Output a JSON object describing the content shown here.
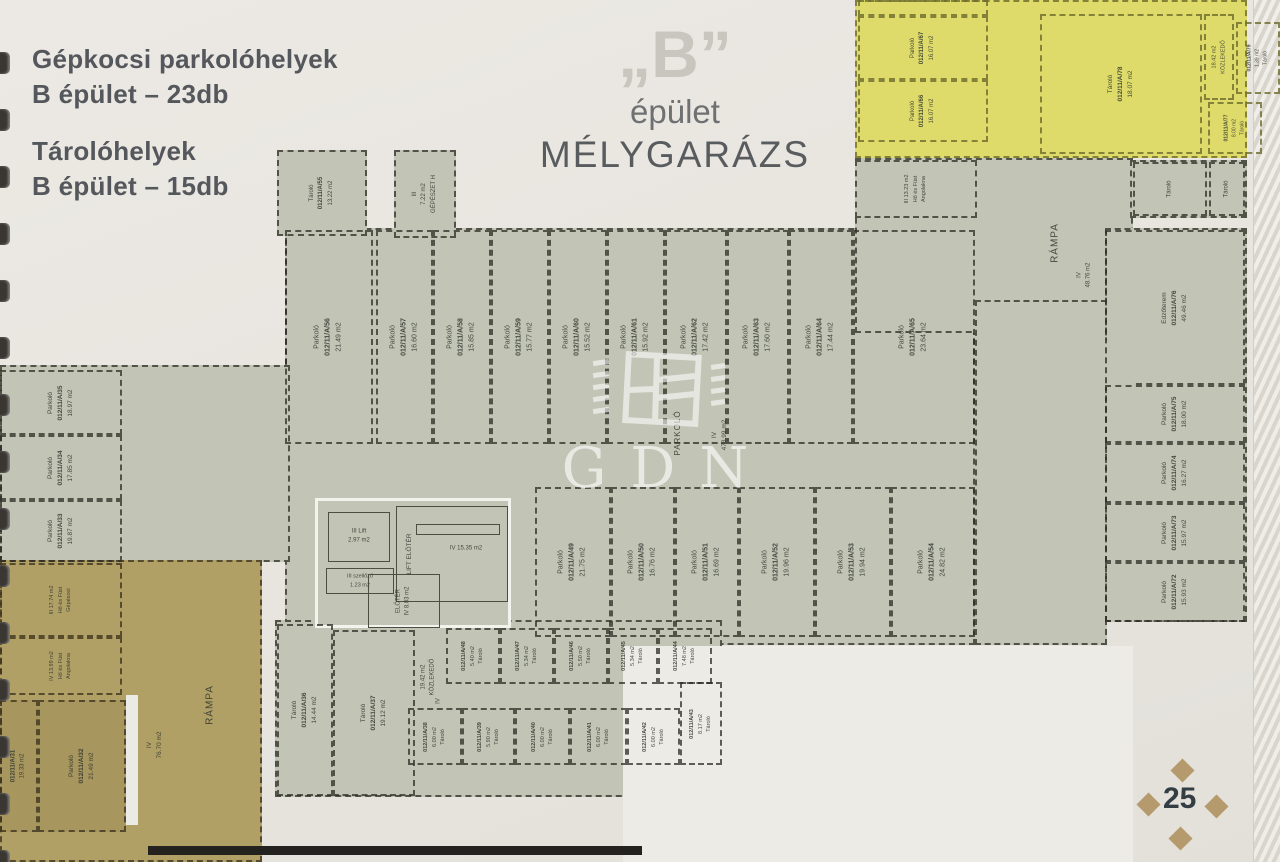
{
  "page": {
    "legend": {
      "line1": "Gépkocsi parkolóhelyek",
      "line2": "B épület – 23db",
      "line3": "Tárolóhelyek",
      "line4": "B épület – 15db"
    },
    "title": {
      "quote": "„B”",
      "sub": "épület",
      "main": "MÉLYGARÁZS"
    },
    "watermark": "GDN",
    "page_number": "25"
  },
  "colors": {
    "floor": "#c2c4b5",
    "gold": "#b1a066",
    "yellow": "#dfdb6b",
    "paper2": "#edebe5",
    "goldstall": "rgba(40,30,5,0.07)"
  },
  "plan": {
    "zones": [
      {
        "n": "zone-main-hall",
        "x": 285,
        "y": 228,
        "w": 690,
        "h": 417,
        "f": "floor",
        "b": 1
      },
      {
        "n": "zone-west-wing",
        "x": 0,
        "y": 365,
        "w": 290,
        "h": 197,
        "f": "floor",
        "b": 1
      },
      {
        "n": "zone-north-east",
        "x": 855,
        "y": 158,
        "w": 278,
        "h": 175,
        "f": "floor",
        "b": 1
      },
      {
        "n": "zone-east-corridor",
        "x": 975,
        "y": 300,
        "w": 132,
        "h": 345,
        "f": "floor",
        "b": 1
      },
      {
        "n": "zone-east-wing",
        "x": 1105,
        "y": 228,
        "w": 142,
        "h": 394,
        "f": "floor",
        "b": 1
      },
      {
        "n": "zone-ne-storerooms",
        "x": 1130,
        "y": 160,
        "w": 117,
        "h": 58,
        "f": "floor",
        "b": 1
      },
      {
        "n": "zone-south-storage",
        "x": 275,
        "y": 620,
        "w": 447,
        "h": 177,
        "f": "floor",
        "b": 1
      },
      {
        "n": "zone-ramp-gold",
        "x": 0,
        "y": 560,
        "w": 262,
        "h": 302,
        "f": "gold",
        "b": 4
      },
      {
        "n": "zone-yellow-garage",
        "x": 855,
        "y": 0,
        "w": 392,
        "h": 158,
        "f": "yellow",
        "b": 3
      },
      {
        "n": "zone-white-cutout",
        "x": 623,
        "y": 646,
        "w": 510,
        "h": 216,
        "f": "paper2",
        "b": 0
      },
      {
        "n": "zone-lift-core",
        "x": 315,
        "y": 498,
        "w": 196,
        "h": 130,
        "f": "floor",
        "b": 5
      }
    ],
    "rooms": [
      {
        "n": "room-tarolo-a55",
        "x": 277,
        "y": 150,
        "w": 90,
        "h": 86,
        "f": "floor",
        "b": 1,
        "t": [
          "Tároló",
          "012/11/A/55",
          "13.22 m2"
        ],
        "r": 1,
        "fs": 6
      },
      {
        "n": "room-gepeszet-h",
        "x": 394,
        "y": 150,
        "w": 62,
        "h": 88,
        "f": "floor",
        "b": 1,
        "t": [
          "III",
          "7.22 m2",
          "GÉPÉSZET H"
        ],
        "r": 1,
        "fs": 6
      },
      {
        "n": "room-parkolo-a56",
        "x": 285,
        "y": 230,
        "w": 88,
        "h": 214,
        "b": 1,
        "t": [
          "Parkoló",
          "012/11/A/56",
          "21.49 m2"
        ],
        "r": 1,
        "fs": 7
      },
      {
        "n": "room-parkolo-a57",
        "x": 376,
        "y": 230,
        "w": 57,
        "h": 214,
        "b": 1,
        "t": [
          "Parkoló",
          "012/11/A/57",
          "16.60 m2"
        ],
        "r": 1,
        "fs": 7
      },
      {
        "n": "room-parkolo-a58",
        "x": 433,
        "y": 230,
        "w": 58,
        "h": 214,
        "b": 1,
        "t": [
          "Parkoló",
          "012/11/A/58",
          "15.85 m2"
        ],
        "r": 1,
        "fs": 7
      },
      {
        "n": "room-parkolo-a59",
        "x": 491,
        "y": 230,
        "w": 58,
        "h": 214,
        "b": 1,
        "t": [
          "Parkoló",
          "012/11/A/59",
          "15.77 m2"
        ],
        "r": 1,
        "fs": 7
      },
      {
        "n": "room-parkolo-a60",
        "x": 549,
        "y": 230,
        "w": 58,
        "h": 214,
        "b": 1,
        "t": [
          "Parkoló",
          "012/11/A/60",
          "15.52 m2"
        ],
        "r": 1,
        "fs": 7
      },
      {
        "n": "room-parkolo-a61",
        "x": 607,
        "y": 230,
        "w": 58,
        "h": 214,
        "b": 1,
        "t": [
          "Parkoló",
          "012/11/A/61",
          "15.92 m2"
        ],
        "r": 1,
        "fs": 7
      },
      {
        "n": "room-parkolo-a62",
        "x": 665,
        "y": 230,
        "w": 62,
        "h": 214,
        "b": 1,
        "t": [
          "Parkoló",
          "012/11/A/62",
          "17.42 m2"
        ],
        "r": 1,
        "fs": 7
      },
      {
        "n": "room-parkolo-a63",
        "x": 727,
        "y": 230,
        "w": 62,
        "h": 214,
        "b": 1,
        "t": [
          "Parkoló",
          "012/11/A/63",
          "17.60 m2"
        ],
        "r": 1,
        "fs": 7
      },
      {
        "n": "room-parkolo-a64",
        "x": 789,
        "y": 230,
        "w": 64,
        "h": 214,
        "b": 1,
        "t": [
          "Parkoló",
          "012/11/A/64",
          "17.44 m2"
        ],
        "r": 1,
        "fs": 7
      },
      {
        "n": "room-parkolo-a65",
        "x": 853,
        "y": 230,
        "w": 122,
        "h": 214,
        "b": 1,
        "t": [
          "Parkoló",
          "012/11/A/65",
          "23.64 m2"
        ],
        "r": 1,
        "fs": 7
      },
      {
        "n": "room-parkolo-a49",
        "x": 535,
        "y": 487,
        "w": 76,
        "h": 150,
        "b": 1,
        "t": [
          "Parkoló",
          "012/11/A/49",
          "21.75 m2"
        ],
        "r": 1,
        "fs": 7
      },
      {
        "n": "room-parkolo-a50",
        "x": 611,
        "y": 487,
        "w": 64,
        "h": 150,
        "b": 1,
        "t": [
          "Parkoló",
          "012/11/A/50",
          "16.76 m2"
        ],
        "r": 1,
        "fs": 7
      },
      {
        "n": "room-parkolo-a51",
        "x": 675,
        "y": 487,
        "w": 64,
        "h": 150,
        "b": 1,
        "t": [
          "Parkoló",
          "012/11/A/51",
          "16.69 m2"
        ],
        "r": 1,
        "fs": 7
      },
      {
        "n": "room-parkolo-a52",
        "x": 739,
        "y": 487,
        "w": 76,
        "h": 150,
        "b": 1,
        "t": [
          "Parkoló",
          "012/11/A/52",
          "19.96 m2"
        ],
        "r": 1,
        "fs": 7
      },
      {
        "n": "room-parkolo-a53",
        "x": 815,
        "y": 487,
        "w": 76,
        "h": 150,
        "b": 1,
        "t": [
          "Parkoló",
          "012/11/A/53",
          "19.94 m2"
        ],
        "r": 1,
        "fs": 7
      },
      {
        "n": "room-parkolo-a54",
        "x": 891,
        "y": 487,
        "w": 84,
        "h": 150,
        "b": 1,
        "t": [
          "Parkoló",
          "012/11/A/54",
          "24.82 m2"
        ],
        "r": 1,
        "fs": 7
      },
      {
        "n": "room-parkolo-a35",
        "x": 0,
        "y": 370,
        "w": 122,
        "h": 65,
        "b": 1,
        "t": [
          "Parkoló",
          "012/11/A/35",
          "18.97 m2"
        ],
        "r": 1,
        "fs": 6.5
      },
      {
        "n": "room-parkolo-a34",
        "x": 0,
        "y": 435,
        "w": 122,
        "h": 65,
        "b": 1,
        "t": [
          "Parkoló",
          "012/11/A/34",
          "17.85 m2"
        ],
        "r": 1,
        "fs": 6.5
      },
      {
        "n": "room-parkolo-a33",
        "x": 0,
        "y": 500,
        "w": 122,
        "h": 62,
        "b": 1,
        "t": [
          "Parkoló",
          "012/11/A/33",
          "19.87 m2"
        ],
        "r": 1,
        "fs": 6.5
      },
      {
        "n": "room-edzoterem-a76",
        "x": 1105,
        "y": 230,
        "w": 140,
        "h": 155,
        "b": 1,
        "cls": "cut-bl",
        "t": [
          "Edzőterem",
          "012/11/A/76",
          "49.46 m2"
        ],
        "r": 1,
        "fs": 6.5
      },
      {
        "n": "room-parkolo-a75",
        "x": 1105,
        "y": 385,
        "w": 140,
        "h": 58,
        "b": 1,
        "t": [
          "Parkoló",
          "012/11/A/75",
          "18.00 m2"
        ],
        "r": 1,
        "fs": 6.5
      },
      {
        "n": "room-parkolo-a74",
        "x": 1105,
        "y": 443,
        "w": 140,
        "h": 60,
        "b": 1,
        "t": [
          "Parkoló",
          "012/11/A/74",
          "16.27 m2"
        ],
        "r": 1,
        "fs": 6.5
      },
      {
        "n": "room-parkolo-a73",
        "x": 1105,
        "y": 503,
        "w": 140,
        "h": 59,
        "b": 1,
        "t": [
          "Parkoló",
          "012/11/A/73",
          "15.97 m2"
        ],
        "r": 1,
        "fs": 6.5
      },
      {
        "n": "room-parkolo-a72",
        "x": 1105,
        "y": 562,
        "w": 140,
        "h": 60,
        "b": 1,
        "t": [
          "Parkoló",
          "012/11/A/72",
          "15.93 m2"
        ],
        "r": 1,
        "fs": 6.5
      },
      {
        "n": "room-parkolo-y-cut",
        "x": 858,
        "y": 0,
        "w": 130,
        "h": 16,
        "b": 3
      },
      {
        "n": "room-parkolo-a67",
        "x": 858,
        "y": 16,
        "w": 130,
        "h": 64,
        "b": 3,
        "t": [
          "Parkoló",
          "012/11/A/67",
          "16.07 m2"
        ],
        "r": 1,
        "fs": 6
      },
      {
        "n": "room-parkolo-a66",
        "x": 858,
        "y": 80,
        "w": 130,
        "h": 62,
        "b": 3,
        "t": [
          "Parkoló",
          "012/11/A/66",
          "16.07 m2"
        ],
        "r": 1,
        "fs": 6
      },
      {
        "n": "room-tarolo-a78",
        "x": 1040,
        "y": 14,
        "w": 162,
        "h": 140,
        "b": 3,
        "t": [
          "Tároló",
          "012/11/A/78",
          "18.07 m2"
        ],
        "r": 1,
        "fs": 6.5
      },
      {
        "n": "room-kozlekedo-ne",
        "x": 1204,
        "y": 14,
        "w": 30,
        "h": 86,
        "b": 3,
        "t": [
          "18.42 m2",
          "KÖZLEKEDŐ"
        ],
        "r": 1,
        "fs": 5.5
      },
      {
        "n": "room-tarolo-a79",
        "x": 1236,
        "y": 22,
        "w": 44,
        "h": 72,
        "b": 3,
        "t": [
          "012/11/A/79",
          "1.39 m2",
          "Tároló"
        ],
        "r": 1,
        "fs": 5
      },
      {
        "n": "room-tarolo-a77",
        "x": 1208,
        "y": 102,
        "w": 54,
        "h": 52,
        "b": 3,
        "t": [
          "012/11/A/77",
          "8.00 m2",
          "Tároló"
        ],
        "r": 1,
        "fs": 5
      },
      {
        "n": "room-ho-fust-angolakna-ne",
        "x": 855,
        "y": 160,
        "w": 122,
        "h": 58,
        "f": "floor",
        "b": 1,
        "t": [
          "III  13.23 m2",
          "Hő és Füst",
          "Angolakna"
        ],
        "r": 1,
        "fs": 5.5
      },
      {
        "n": "room-tarolo-ne-1",
        "x": 1133,
        "y": 162,
        "w": 74,
        "h": 54,
        "b": 1,
        "t": [
          "Tároló"
        ],
        "r": 1,
        "fs": 6
      },
      {
        "n": "room-tarolo-ne-2",
        "x": 1209,
        "y": 162,
        "w": 36,
        "h": 54,
        "b": 1,
        "t": [
          "Tároló"
        ],
        "r": 1,
        "fs": 6
      },
      {
        "n": "label-rampa-ne",
        "x": 1020,
        "y": 168,
        "w": 70,
        "h": 150,
        "b": 0,
        "t": [
          "RÁMPA"
        ],
        "r": 1,
        "fs": 10,
        "ls": 1
      },
      {
        "n": "label-rampa-ne-area",
        "x": 1055,
        "y": 230,
        "w": 60,
        "h": 90,
        "b": 0,
        "t": [
          "IV",
          "48.76 m2"
        ],
        "r": 1,
        "fs": 6
      },
      {
        "n": "label-parkolo-main",
        "x": 655,
        "y": 375,
        "w": 45,
        "h": 115,
        "b": 0,
        "t": [
          "PARKOLÓ"
        ],
        "r": 1,
        "fs": 8,
        "ls": 1
      },
      {
        "n": "label-parkolo-main-area",
        "x": 697,
        "y": 385,
        "w": 45,
        "h": 100,
        "b": 0,
        "t": [
          "IV",
          "473.99 m2"
        ],
        "r": 1,
        "fs": 6.5
      },
      {
        "n": "room-lift",
        "x": 328,
        "y": 512,
        "w": 62,
        "h": 50,
        "b": 2,
        "t": [
          "III      Lift",
          "2.97 m2"
        ],
        "r": 0,
        "fs": 6
      },
      {
        "n": "room-szellozo",
        "x": 326,
        "y": 568,
        "w": 68,
        "h": 26,
        "b": 2,
        "t": [
          "III  szellőző",
          "1.23 m2"
        ],
        "r": 0,
        "fs": 5.5
      },
      {
        "n": "room-lift-eloter",
        "x": 396,
        "y": 506,
        "w": 112,
        "h": 96,
        "b": 2
      },
      {
        "n": "room-stair-bar",
        "x": 416,
        "y": 524,
        "w": 84,
        "h": 11,
        "b": 2
      },
      {
        "n": "label-lift-eloter",
        "x": 398,
        "y": 510,
        "w": 24,
        "h": 88,
        "b": 0,
        "t": [
          "LIFT ELŐTÉR"
        ],
        "r": 1,
        "fs": 6.5
      },
      {
        "n": "label-lift-eloter-area",
        "x": 428,
        "y": 534,
        "w": 76,
        "h": 30,
        "b": 0,
        "t": [
          "IV      15.35 m2"
        ],
        "r": 0,
        "fs": 6
      },
      {
        "n": "room-eloter",
        "x": 368,
        "y": 574,
        "w": 72,
        "h": 54,
        "b": 2,
        "t": [
          "ELŐTÉR",
          "IV  8.03 m2"
        ],
        "r": 1,
        "fs": 6
      },
      {
        "n": "room-ho-fust-gepeszet",
        "x": 0,
        "y": 563,
        "w": 122,
        "h": 74,
        "b": 4,
        "t": [
          "III  17.74 m2",
          "Hő és Füst",
          "Gépészet"
        ],
        "r": 1,
        "fs": 5.5
      },
      {
        "n": "room-ho-fust-angolakna-sw",
        "x": 0,
        "y": 637,
        "w": 122,
        "h": 58,
        "b": 4,
        "t": [
          "IV  13.99 m2",
          "Hő és Füst",
          "Angolakna"
        ],
        "r": 1,
        "fs": 5.5
      },
      {
        "n": "room-parkolo-a31",
        "x": 0,
        "y": 700,
        "w": 38,
        "h": 132,
        "f": "goldstall",
        "b": 4,
        "t": [
          "012/11/A/31",
          "19.33 m2"
        ],
        "r": 1,
        "fs": 6
      },
      {
        "n": "room-parkolo-a32",
        "x": 38,
        "y": 700,
        "w": 88,
        "h": 132,
        "f": "goldstall",
        "b": 4,
        "t": [
          "Parkoló",
          "012/11/A/32",
          "21.49 m2"
        ],
        "r": 1,
        "fs": 6.5
      },
      {
        "n": "wall-gap-gold",
        "x": 126,
        "y": 695,
        "w": 12,
        "h": 130,
        "f": "#eceae4",
        "b": 0
      },
      {
        "n": "label-rampa-sw",
        "x": 180,
        "y": 635,
        "w": 60,
        "h": 140,
        "b": 0,
        "t": [
          "RÁMPA"
        ],
        "r": 1,
        "fs": 10,
        "ls": 1
      },
      {
        "n": "label-rampa-sw-area",
        "x": 125,
        "y": 690,
        "w": 60,
        "h": 110,
        "b": 0,
        "t": [
          "IV",
          "76.70 m2"
        ],
        "r": 1,
        "fs": 6.5
      },
      {
        "n": "room-tarolo-a36",
        "x": 277,
        "y": 624,
        "w": 56,
        "h": 172,
        "b": 1,
        "t": [
          "Tároló",
          "012/11/A/36",
          "14.44 m2"
        ],
        "r": 1,
        "fs": 6.5
      },
      {
        "n": "room-tarolo-a37",
        "x": 333,
        "y": 630,
        "w": 82,
        "h": 166,
        "b": 1,
        "t": [
          "Tároló",
          "012/11/A/37",
          "19.12 m2"
        ],
        "r": 1,
        "fs": 6.5
      },
      {
        "n": "label-kozlekedo-south",
        "x": 412,
        "y": 632,
        "w": 34,
        "h": 90,
        "b": 0,
        "t": [
          "19.42 m2",
          "KÖZLEKEDŐ"
        ],
        "r": 1,
        "fs": 6
      },
      {
        "n": "label-kozlekedo-south-iv",
        "x": 428,
        "y": 688,
        "w": 22,
        "h": 26,
        "b": 0,
        "t": [
          "IV"
        ],
        "r": 1,
        "fs": 6
      },
      {
        "n": "room-tarolo-a48",
        "x": 446,
        "y": 628,
        "w": 54,
        "h": 56,
        "b": 1,
        "t": [
          "012/11/A/48",
          "5.40 m2",
          "Tároló"
        ],
        "r": 1,
        "fs": 5.5
      },
      {
        "n": "room-tarolo-a47",
        "x": 500,
        "y": 628,
        "w": 54,
        "h": 56,
        "b": 1,
        "t": [
          "012/11/A/47",
          "5.34 m2",
          "Tároló"
        ],
        "r": 1,
        "fs": 5.5
      },
      {
        "n": "room-tarolo-a46",
        "x": 554,
        "y": 628,
        "w": 54,
        "h": 56,
        "b": 1,
        "t": [
          "012/11/A/46",
          "5.50 m2",
          "Tároló"
        ],
        "r": 1,
        "fs": 5.5
      },
      {
        "n": "room-tarolo-a45",
        "x": 608,
        "y": 628,
        "w": 50,
        "h": 56,
        "b": 1,
        "t": [
          "012/11/A/45",
          "5.34 m2",
          "Tároló"
        ],
        "r": 1,
        "fs": 5.5
      },
      {
        "n": "room-tarolo-a44",
        "x": 658,
        "y": 628,
        "w": 54,
        "h": 56,
        "b": 1,
        "t": [
          "012/11/A/44",
          "7.48 m2",
          "Tároló"
        ],
        "r": 1,
        "fs": 5.5
      },
      {
        "n": "room-tarolo-a38",
        "x": 408,
        "y": 708,
        "w": 54,
        "h": 57,
        "b": 1,
        "t": [
          "012/11/A/38",
          "6.00 m2",
          "Tároló"
        ],
        "r": 1,
        "fs": 5.5
      },
      {
        "n": "room-tarolo-a39",
        "x": 462,
        "y": 708,
        "w": 53,
        "h": 57,
        "b": 1,
        "t": [
          "012/11/A/39",
          "5.90 m2",
          "Tároló"
        ],
        "r": 1,
        "fs": 5.5
      },
      {
        "n": "room-tarolo-a40",
        "x": 515,
        "y": 708,
        "w": 55,
        "h": 57,
        "b": 1,
        "t": [
          "012/11/A/40",
          "6.00 m2",
          "Tároló"
        ],
        "r": 1,
        "fs": 5.5
      },
      {
        "n": "room-tarolo-a41",
        "x": 570,
        "y": 708,
        "w": 57,
        "h": 57,
        "b": 1,
        "t": [
          "012/11/A/41",
          "6.00 m2",
          "Tároló"
        ],
        "r": 1,
        "fs": 5.5
      },
      {
        "n": "room-tarolo-a42",
        "x": 627,
        "y": 708,
        "w": 53,
        "h": 57,
        "b": 1,
        "t": [
          "012/11/A/42",
          "6.00 m2",
          "Tároló"
        ],
        "r": 1,
        "fs": 5.5
      },
      {
        "n": "room-tarolo-a43",
        "x": 680,
        "y": 682,
        "w": 42,
        "h": 83,
        "b": 1,
        "t": [
          "012/11/A/43",
          "8.17 m2",
          "Tároló"
        ],
        "r": 1,
        "fs": 5.5
      },
      {
        "n": "wall-south-boundary",
        "x": 148,
        "y": 846,
        "w": 494,
        "h": 9,
        "f": "#23221e",
        "b": 0
      }
    ]
  }
}
